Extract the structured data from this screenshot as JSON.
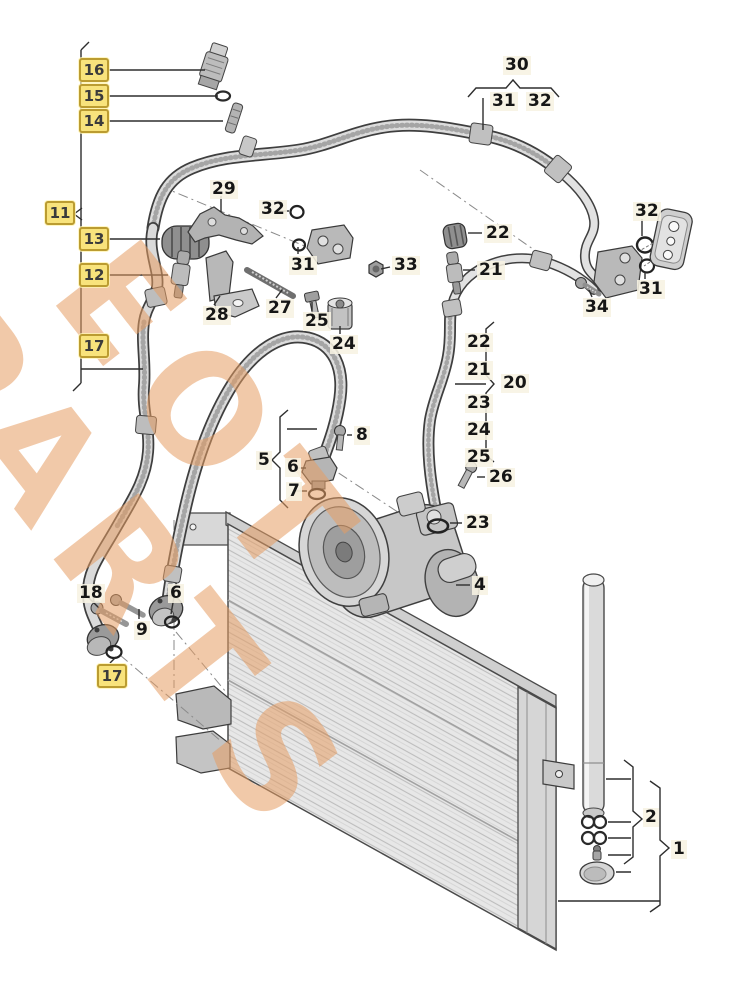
{
  "diagram": {
    "kind": "exploded-parts-diagram air-conditioning condenser compressor hoses",
    "colors": {
      "highlight_fill": "#f8e37c",
      "highlight_border": "#bb9c31",
      "line": "#2e2e2e",
      "metal_light": "#e4e4e4",
      "metal_mid": "#c3c3c3",
      "metal_dark": "#909090",
      "watermark": "#e59d62"
    },
    "callouts": {
      "boxed": {
        "b16": "16",
        "b15": "15",
        "b14": "14",
        "b11": "11",
        "b13": "13",
        "b12": "12",
        "b17a": "17",
        "b17b": "17"
      },
      "plain": {
        "n29": "29",
        "n32l": "32",
        "n31l": "31",
        "n33": "33",
        "n28": "28",
        "n27": "27",
        "n25": "25",
        "n24": "24",
        "n30": "30",
        "n31t": "31",
        "n32t": "32",
        "n22t": "22",
        "n21t": "21",
        "n32r": "32",
        "n31r": "31",
        "n34": "34",
        "g22": "22",
        "g21": "21",
        "g23": "23",
        "g24": "24",
        "g25": "25",
        "n20": "20",
        "n26": "26",
        "n23": "23",
        "n8": "8",
        "n5": "5",
        "n6c": "6",
        "n7": "7",
        "n4": "4",
        "n18": "18",
        "n9": "9",
        "n6b": "6",
        "n2": "2",
        "n1": "1"
      }
    },
    "watermark": {
      "line1": "EOT",
      "line2": "PARTS"
    }
  }
}
